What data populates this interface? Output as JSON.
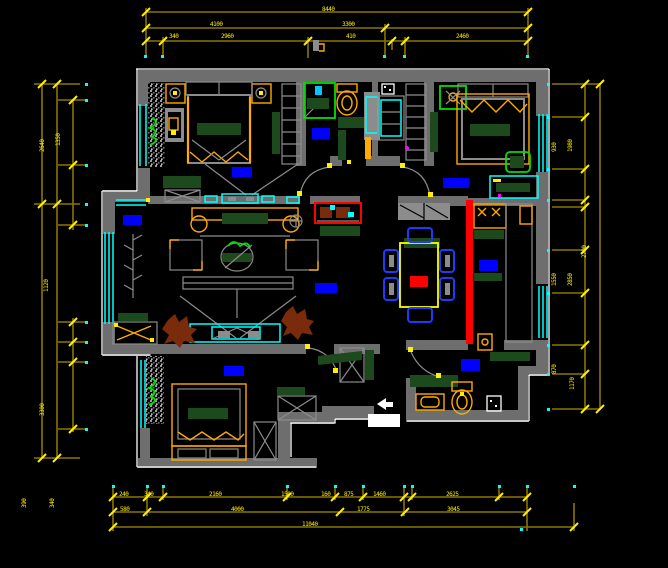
{
  "canvas": {
    "description": "apartment floor plan CAD drawing on black background"
  },
  "palette": {
    "background": "#000000",
    "wall": "#6e6e6e",
    "wall_outline": "#ffffff",
    "dimension_line": "#8a7500",
    "dimension_text": "#ffef00",
    "window_glass": "#00ffff",
    "furniture_frame": "#ffaa00",
    "bed_linen": "#1c4a1c",
    "room_label": "#0000ff",
    "highlight_wall": "#ff0000",
    "plant": "#7a2b0b",
    "fixture_green": "#00e000",
    "chair_blue": "#1a3cff"
  },
  "dims": {
    "top": [
      "8440",
      "4100",
      "3300",
      "340",
      "2960",
      "410",
      "2460"
    ],
    "left": [
      "2640",
      "1350",
      "1120",
      "3300",
      "390",
      "340"
    ],
    "right": [
      "930",
      "1980",
      "2700",
      "1550",
      "2850",
      "870",
      "1170"
    ],
    "bottom": [
      "240",
      "340",
      "2160",
      "1500",
      "160",
      "875",
      "1460",
      "2625",
      "580",
      "4000",
      "1775",
      "3045",
      "11040"
    ]
  }
}
